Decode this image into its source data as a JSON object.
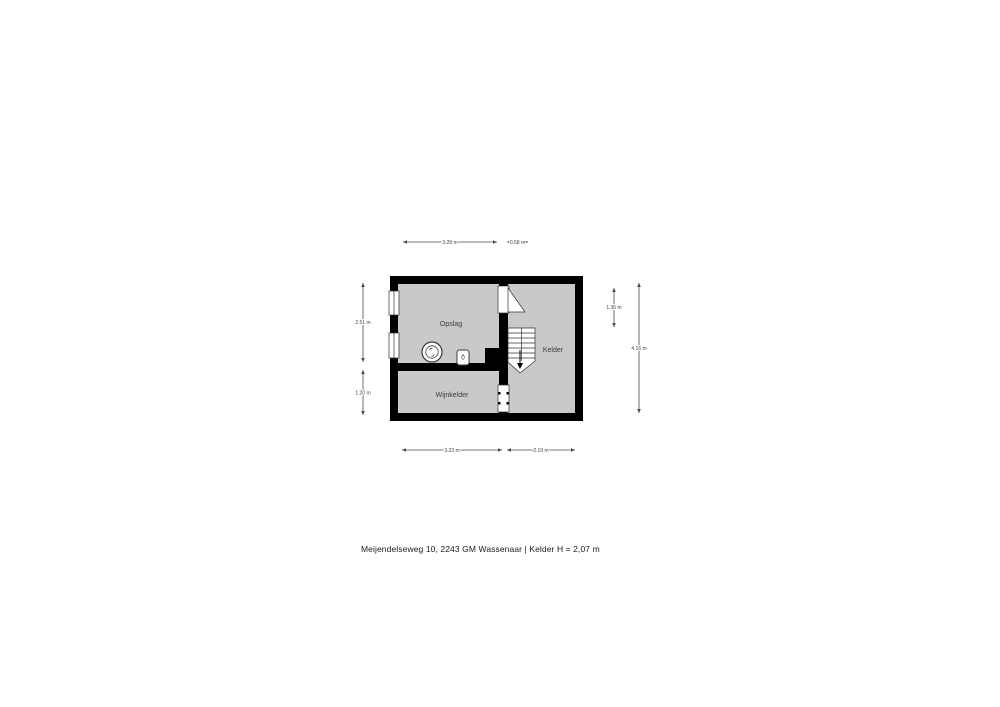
{
  "page": {
    "background": "#ffffff",
    "caption": "Meijendelseweg 10, 2243 GM Wassenaar | Kelder H = 2,07 m"
  },
  "floorplan": {
    "type": "basement-floor-plan",
    "colors": {
      "wall": "#000000",
      "floor": "#c9c9c9",
      "dimension": "#4a4a4a",
      "room_label": "#3a3a3a",
      "fixture_stroke": "#3a3a3a"
    },
    "rooms": [
      {
        "name": "Opslag"
      },
      {
        "name": "Kelder"
      },
      {
        "name": "Wijnkelder"
      }
    ],
    "fixtures": [
      {
        "name": "washing-machine"
      },
      {
        "name": "boiler"
      }
    ],
    "features": [
      {
        "name": "stairs-down"
      },
      {
        "name": "door-opslag-kelder"
      },
      {
        "name": "door-wijnkelder-kelder"
      },
      {
        "name": "window-left-upper"
      },
      {
        "name": "window-left-lower"
      }
    ],
    "dimensions": {
      "top": [
        {
          "label": "3.28 m"
        },
        {
          "label": "0.58 m"
        }
      ],
      "bottom": [
        {
          "label": "3.23 m"
        },
        {
          "label": "2.19 m"
        }
      ],
      "left": [
        {
          "label": "2.51 m"
        },
        {
          "label": "1.20 m"
        }
      ],
      "right": [
        {
          "label": "1.36 m"
        },
        {
          "label": "4.16 m"
        }
      ]
    }
  }
}
